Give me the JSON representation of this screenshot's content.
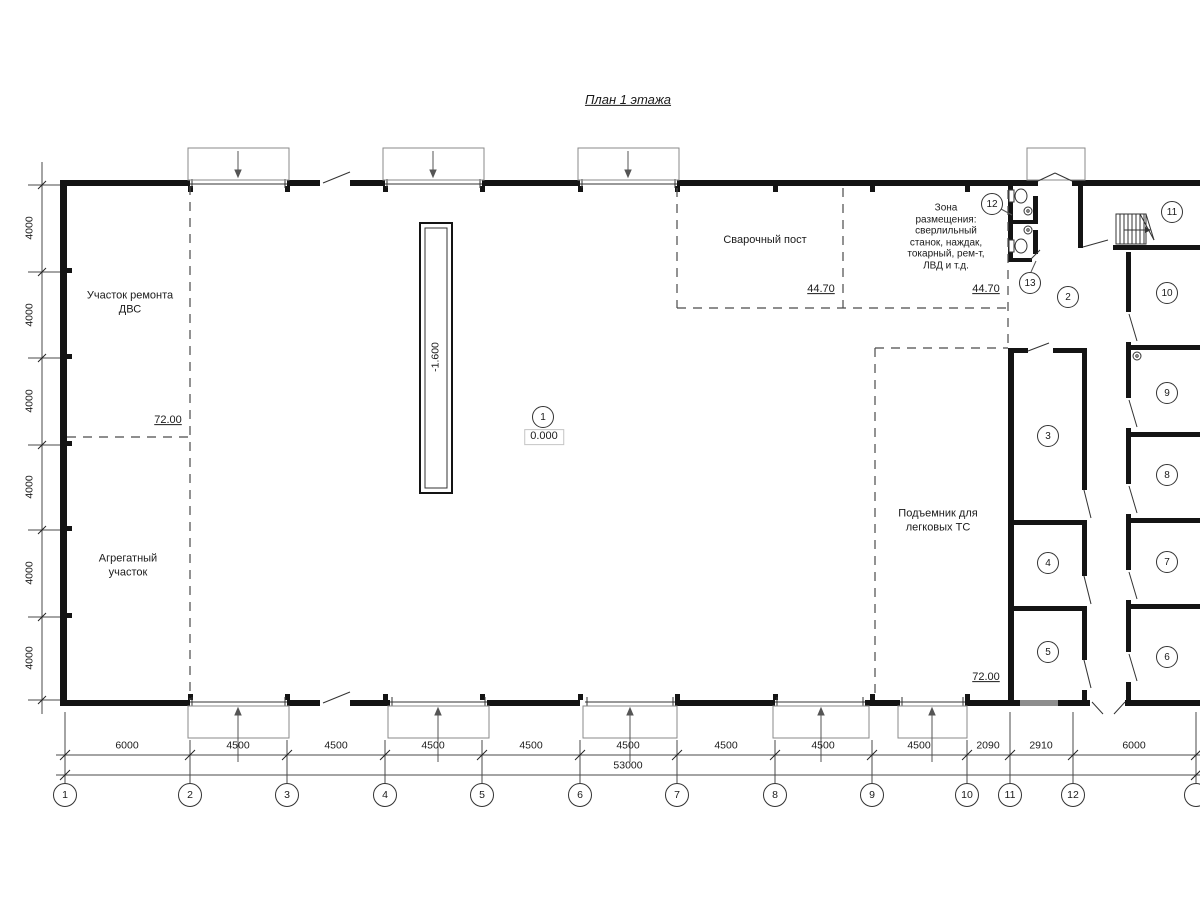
{
  "title": "План 1 этажа",
  "zones": {
    "dvs": "Участок ремонта\nДВС",
    "aggregate": "Агрегатный\nучасток",
    "welding": "Сварочный пост",
    "placement": "Зона\nразмещения:\nсверлильный\nстанок, наждак,\nтокарный, рем-т,\nЛВД и т.д.",
    "lift": "Подъемник для\nлегковых ТС"
  },
  "marks": {
    "level_main": "0.000",
    "level_pit": "-1.600",
    "area_dvs": "72.00",
    "area_lift": "72.00",
    "area_welding": "44.70",
    "area_placement": "44.70"
  },
  "rooms": [
    "1",
    "2",
    "3",
    "4",
    "5",
    "6",
    "7",
    "8",
    "9",
    "10",
    "11",
    "12",
    "13"
  ],
  "axes": [
    "1",
    "2",
    "3",
    "4",
    "5",
    "6",
    "7",
    "8",
    "9",
    "10",
    "11",
    "12"
  ],
  "dims_bottom": [
    "6000",
    "4500",
    "4500",
    "4500",
    "4500",
    "4500",
    "4500",
    "4500",
    "4500",
    "2090",
    "2910",
    "6000"
  ],
  "dim_total": "53000",
  "dims_left": [
    "4000",
    "4000",
    "4000",
    "4000",
    "4000",
    "4000"
  ]
}
